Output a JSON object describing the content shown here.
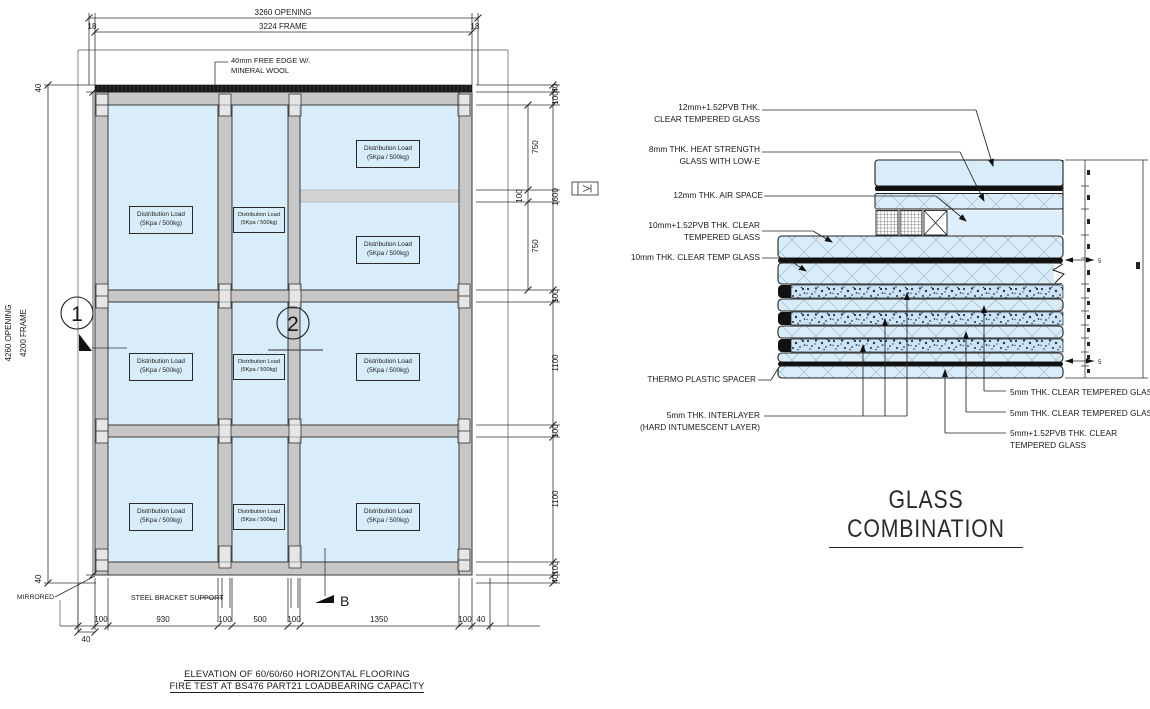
{
  "elevation": {
    "dims": {
      "top_opening": "3260 OPENING",
      "top_frame": "3224 FRAME",
      "end_left": "18",
      "end_right": "18",
      "left_opening": "4260 OPENING",
      "left_frame": "4200 FRAME",
      "left_top": "40",
      "left_bottom": "40",
      "right_outer": [
        "40",
        "100",
        "1600",
        "100",
        "1100",
        "100",
        "1100",
        "100",
        "40"
      ],
      "right_inner": [
        "750",
        "100",
        "750"
      ],
      "bottom": [
        "100",
        "930",
        "100",
        "500",
        "100",
        "1350",
        "100",
        "40"
      ],
      "bottom_outer_left": "40"
    },
    "callouts": {
      "one": "1",
      "two": "2",
      "section": "B"
    },
    "labels": {
      "free_edge1": "40mm FREE EDGE W/.",
      "free_edge2": "MINERAL WOOL",
      "mirrored": "MIRRORED",
      "steel_bracket": "STEEL BRACKET SUPPORT"
    },
    "load_box": {
      "line1": "Distribution Load",
      "line2": "(5Kpa / 500kg)"
    },
    "title1": "ELEVATION OF 60/60/60 HORIZONTAL FLOORING",
    "title2": "FIRE TEST AT BS476 PART21 LOADBEARING CAPACITY"
  },
  "glass": {
    "title": "GLASS COMBINATION",
    "labels_left": [
      [
        "12mm+1.52PVB THK.",
        "CLEAR TEMPERED GLASS"
      ],
      [
        "8mm THK. HEAT STRENGTH",
        "GLASS WITH LOW-E"
      ],
      [
        "12mm THK. AIR SPACE",
        ""
      ],
      [
        "10mm+1.52PVB THK. CLEAR",
        "TEMPERED GLASS"
      ],
      [
        "10mm THK. CLEAR TEMP GLASS",
        ""
      ],
      [
        "THERMO PLASTIC SPACER",
        ""
      ],
      [
        "5mm THK. INTERLAYER",
        "(HARD INTUMESCENT LAYER)"
      ]
    ],
    "labels_right": [
      [
        "5mm THK. CLEAR TEMPERED GLASS",
        ""
      ],
      [
        "5mm THK. CLEAR TEMPERED GLASS",
        ""
      ],
      [
        "5mm+1.52PVB THK. CLEAR",
        "TEMPERED GLASS"
      ]
    ],
    "dim_5_top": "5",
    "dim_5_bottom": "5"
  },
  "colors": {
    "glass": "#d9ecf9",
    "frame": "#c7c7c7",
    "line": "#2a2a2a",
    "dark": "#141414"
  }
}
